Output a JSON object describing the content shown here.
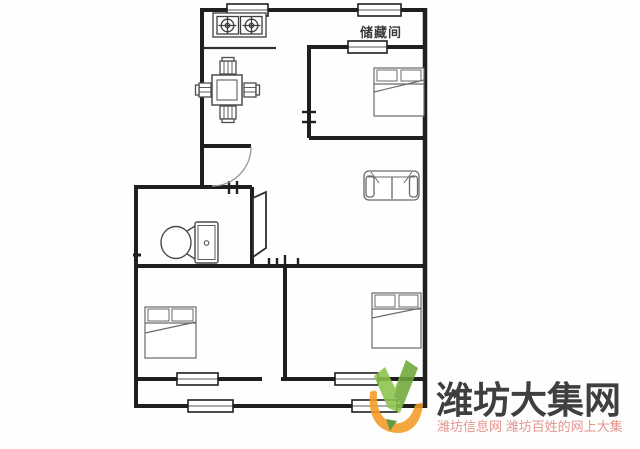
{
  "floorplan": {
    "storage_room_label": "储藏间",
    "wall_color": "#1f1f1f",
    "furniture_color": "#4d4d4d"
  },
  "watermark": {
    "title": "潍坊大集网",
    "subtitle": "潍坊信息网 潍坊百姓的网上大集",
    "colors": {
      "title_text": "#3f3f3f",
      "subtitle_text": "#e5948c",
      "check_light_green": "#8bc34a",
      "check_dark_green": "#6fa83a",
      "swoosh_orange": "#f59b24",
      "leaf_green": "#4f8d2c"
    }
  }
}
